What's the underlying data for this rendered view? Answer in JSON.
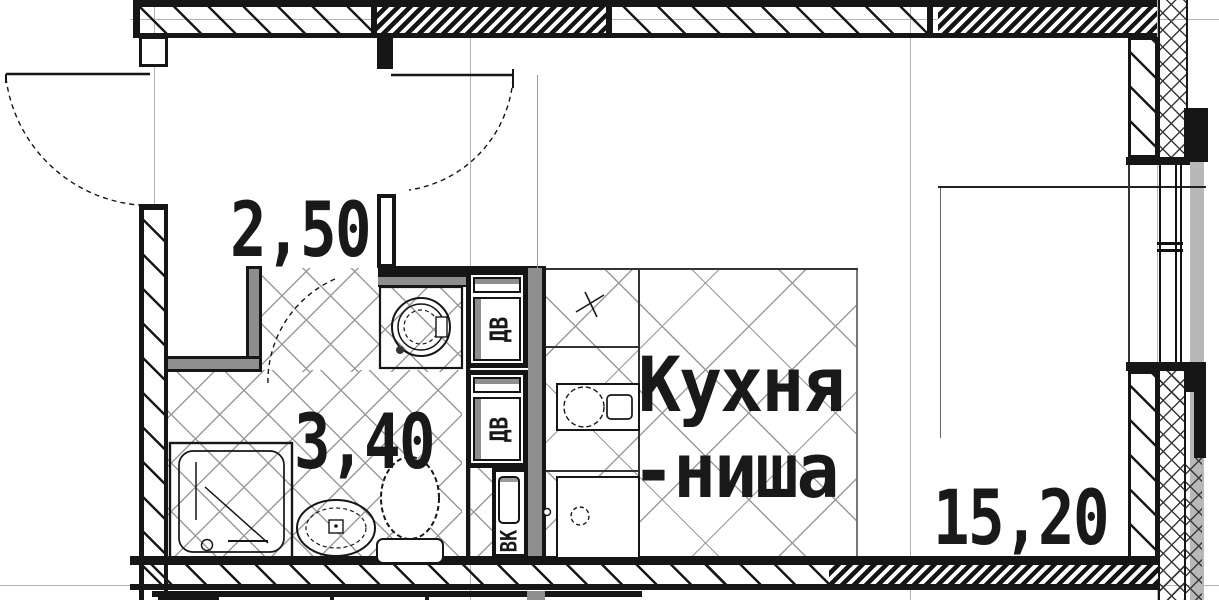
{
  "drawing": {
    "kind": "apartment floor plan (studio), russian architectural drawing",
    "rooms": [
      {
        "key": "hallway",
        "area": "2,50"
      },
      {
        "key": "bathroom",
        "area": "3,40"
      },
      {
        "key": "kitchen_niche",
        "name_line1": "Кухня",
        "name_line2": "-ниша"
      },
      {
        "key": "living_room",
        "area": "15,20"
      }
    ],
    "shafts": [
      {
        "label": "ДВ"
      },
      {
        "label": "ДВ"
      },
      {
        "label": "ВК"
      }
    ],
    "colors": {
      "wall": "#161616",
      "partition_gray": "#8e8e8e",
      "facade_gray": "#b8b8b8",
      "tile_line": "#9a9a9a",
      "axis_line": "#b4b4b4",
      "text": "#191919",
      "background": "#ffffff"
    }
  }
}
